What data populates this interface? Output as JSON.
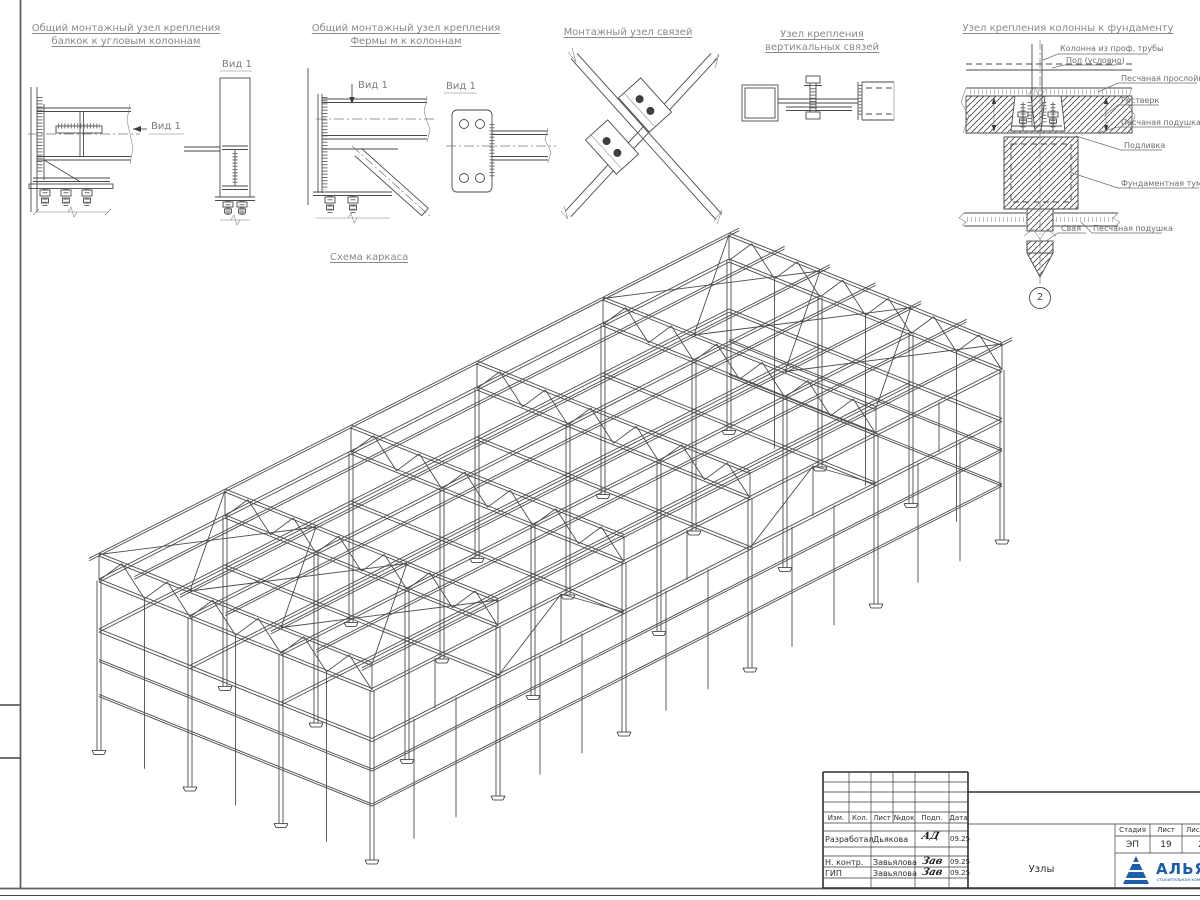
{
  "details": [
    {
      "title_lines": [
        "Общий монтажный узел крепления",
        "балкок к угловым колоннам"
      ],
      "view_front": "Вид 1",
      "view_side": "Вид 1"
    },
    {
      "title_lines": [
        "Общий монтажный узел крепления",
        "Фермы м к колоннам"
      ],
      "view_front": "Вид 1",
      "view_side": "Вид 1"
    },
    {
      "title_lines": [
        "Монтажный узел связей"
      ]
    },
    {
      "title_lines": [
        "Узел крепления",
        "вертикальных связей"
      ]
    },
    {
      "title_lines": [
        "Узел крепления колонны к фундаменту"
      ],
      "callouts": [
        "Колонна из проф. трубы",
        "Пол (условно)",
        "Песчаная прослойка",
        "Ростверк",
        "Песчаная подушка",
        "Подливка",
        "Фундаментная тумба",
        "Свая",
        "Песчаная подушка"
      ],
      "marker": "2"
    }
  ],
  "scheme_title": "Схема каркаса",
  "titleblock": {
    "rev_header": [
      "Изм.",
      "Кол.",
      "Лист",
      "№док",
      "Подп.",
      "Дата"
    ],
    "rows": [
      {
        "role": "Разработал",
        "name": "Дьякова",
        "sig": "АД",
        "date": "09.25"
      },
      {
        "role": "Н. контр.",
        "name": "Завьялова",
        "sig": "Зав",
        "date": "09.25"
      },
      {
        "role": "ГИП",
        "name": "Завьялова",
        "sig": "Зав",
        "date": "09.25"
      }
    ],
    "doc_title": "Узлы",
    "stage_header": [
      "Стадия",
      "Лист",
      "Лис"
    ],
    "stage_values": [
      "ЭП",
      "19",
      "2"
    ],
    "logo_text": "АЛЬЯН",
    "logo_subtext": "строительная компания"
  }
}
